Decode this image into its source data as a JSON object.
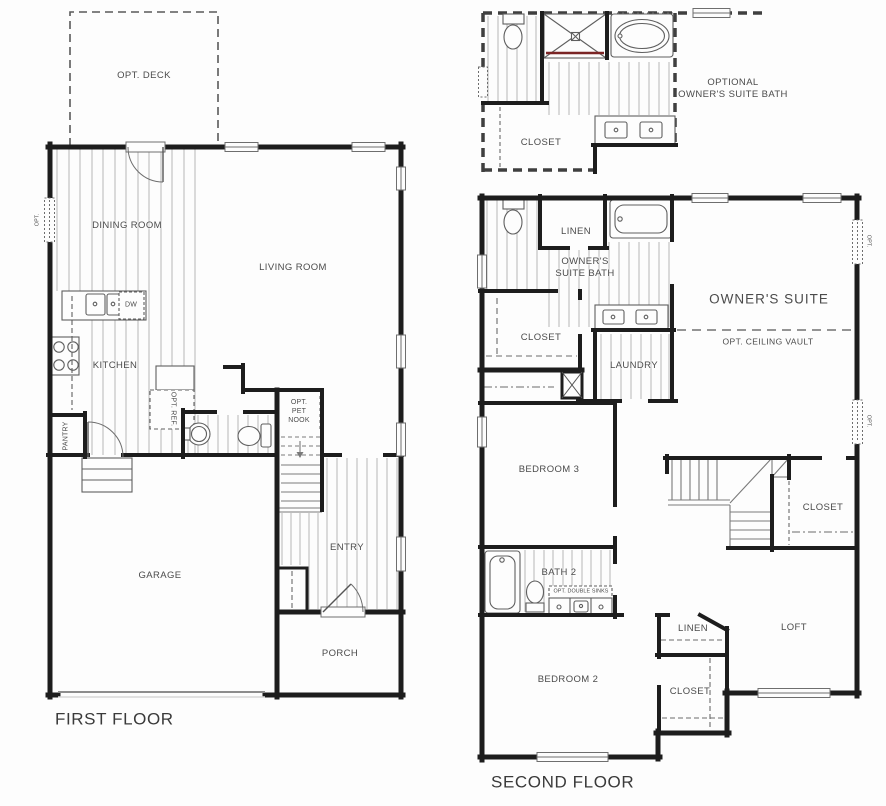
{
  "colors": {
    "background": "#fdfdfd",
    "wall": "#1d1d1d",
    "hatch": "#b6b6b6",
    "fixture_line": "#5f5f5f",
    "label_text": "#4b4b4b",
    "shower_accent": "#7b2525"
  },
  "first_floor": {
    "title": "FIRST FLOOR",
    "labels": {
      "opt_deck": "OPT. DECK",
      "dining_room": "DINING ROOM",
      "living_room": "LIVING ROOM",
      "kitchen": "KITCHEN",
      "dw": "DW",
      "opt_ref": "OPT. REF.",
      "pantry": "PANTRY",
      "opt_pet_nook": "OPT. PET NOOK",
      "entry": "ENTRY",
      "garage": "GARAGE",
      "porch": "PORCH",
      "opt_window": "OPT."
    }
  },
  "second_floor": {
    "title": "SECOND FLOOR",
    "inset": {
      "title_line1": "OPTIONAL",
      "title_line2": "OWNER'S SUITE BATH",
      "closet": "CLOSET"
    },
    "labels": {
      "linen_upper": "LINEN",
      "owners_suite_bath": "OWNER'S SUITE BATH",
      "owners_suite": "OWNER'S SUITE",
      "opt_ceiling_vault": "OPT. CEILING VAULT",
      "closet_owners": "CLOSET",
      "laundry": "LAUNDRY",
      "bedroom_3": "BEDROOM 3",
      "closet_stair": "CLOSET",
      "bath_2": "BATH 2",
      "opt_double_sinks": "OPT. DOUBLE SINKS",
      "bedroom_2": "BEDROOM 2",
      "linen_lower": "LINEN",
      "closet_bed2": "CLOSET",
      "loft": "LOFT",
      "opt_window_upper": "OPT.",
      "opt_window_lower": "OPT."
    }
  }
}
